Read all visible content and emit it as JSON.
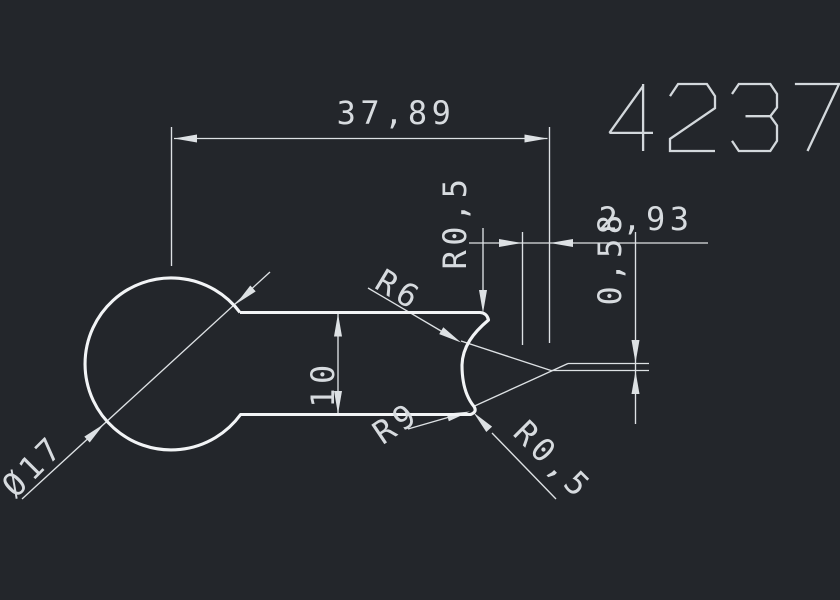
{
  "drawing_number": "4237",
  "canvas": {
    "width": 840,
    "height": 600,
    "background": "#23262b"
  },
  "colors": {
    "background": "#23262b",
    "outline": "#f2f4f6",
    "dimension": "#dde1e4",
    "text": "#d7dbdf",
    "digits": "#d3d8dc"
  },
  "part": {
    "description": "keyhole profile: circle with flat tongue ending in concave notch",
    "outline_path": "M 240 312.5 L 480 312.5 Q 487 313 488.5 320 C 473 333 462.5 347 462 365 C 462 386 467 398 474 406.5 Q 477.5 412 470.5 414.5 L 240.6 414.5 A 86 86 0 1 1 240 312.5",
    "outline_width": 3.1
  },
  "dimensions": {
    "line_width": 1.35,
    "arrow_length": 23,
    "arrow_half_width": 4,
    "font_size": 32,
    "letter_spacing": 4.5,
    "lines": [
      {
        "name": "ext-line-left-37-89",
        "p": [
          171.5,
          127,
          171.5,
          266
        ]
      },
      {
        "name": "ext-line-right-37-89",
        "p": [
          549.5,
          127,
          549.5,
          343
        ]
      },
      {
        "name": "dim-line-37-89",
        "p": [
          174,
          138.5,
          547.5,
          138.5
        ]
      },
      {
        "name": "ext-line-left-2-93",
        "p": [
          522.5,
          232,
          522.5,
          345
        ]
      },
      {
        "name": "dim-line-2-93",
        "p": [
          469,
          243,
          708,
          243
        ]
      },
      {
        "name": "dim-line-0-58",
        "p": [
          635.5,
          232,
          635.5,
          424
        ]
      },
      {
        "name": "ext-line-upper-0-58",
        "p": [
          568,
          363.5,
          649,
          363.5
        ]
      },
      {
        "name": "ext-line-lower-0-58",
        "p": [
          551,
          370.5,
          649,
          370.5
        ]
      },
      {
        "name": "ext-diagonal-upper",
        "p": [
          461,
          341,
          551,
          370.5
        ]
      },
      {
        "name": "ext-diagonal-lower",
        "p": [
          473.5,
          406.5,
          568,
          363.5
        ]
      },
      {
        "name": "leader-r05-top",
        "p": [
          483,
          228,
          483,
          296
        ]
      },
      {
        "name": "dim-line-10",
        "p": [
          338,
          313,
          338,
          414.5
        ]
      },
      {
        "name": "leader-r6",
        "p": [
          368,
          288,
          447,
          334.5
        ]
      },
      {
        "name": "leader-r9",
        "p": [
          408,
          429,
          453,
          416
        ]
      },
      {
        "name": "leader-r05-bottom",
        "p": [
          492,
          433,
          556,
          499
        ]
      },
      {
        "name": "dim-line-dia17",
        "p": [
          22,
          499,
          270,
          272
        ]
      }
    ],
    "arrows": [
      {
        "name": "arrow-37-89-left",
        "tip": [
          174,
          138.5
        ],
        "angle": 180
      },
      {
        "name": "arrow-37-89-right",
        "tip": [
          547.5,
          138.5
        ],
        "angle": 0
      },
      {
        "name": "arrow-2-93-left",
        "tip": [
          522,
          243
        ],
        "angle": 0
      },
      {
        "name": "arrow-2-93-right",
        "tip": [
          550,
          243
        ],
        "angle": 180
      },
      {
        "name": "arrow-0-58-top",
        "tip": [
          635.5,
          363
        ],
        "angle": 90
      },
      {
        "name": "arrow-0-58-bottom",
        "tip": [
          635.5,
          371
        ],
        "angle": 270
      },
      {
        "name": "arrow-r05-top",
        "tip": [
          483,
          313
        ],
        "angle": 90
      },
      {
        "name": "arrow-10-top",
        "tip": [
          338,
          313.5
        ],
        "angle": 270
      },
      {
        "name": "arrow-10-bottom",
        "tip": [
          338,
          414
        ],
        "angle": 90
      },
      {
        "name": "arrow-r6",
        "tip": [
          461,
          342.5
        ],
        "angle": 31
      },
      {
        "name": "arrow-r9",
        "tip": [
          470,
          411.5
        ],
        "angle": -15
      },
      {
        "name": "arrow-r05-bottom",
        "tip": [
          473.5,
          412.5
        ],
        "angle": 227
      },
      {
        "name": "arrow-dia17-lower",
        "tip": [
          104,
          424
        ],
        "angle": -42.5
      },
      {
        "name": "arrow-dia17-upper",
        "tip": [
          236,
          304
        ],
        "angle": 137.5
      }
    ],
    "texts": [
      {
        "name": "dim-text-37-89",
        "value": "37,89",
        "x": 396,
        "y": 113,
        "rot": 0
      },
      {
        "name": "dim-text-2-93",
        "value": "2,93",
        "x": 646,
        "y": 219,
        "rot": 0
      },
      {
        "name": "dim-text-0-58",
        "value": "0,58",
        "x": 610,
        "y": 258,
        "rot": -90
      },
      {
        "name": "dim-text-r05-top",
        "value": "R0,5",
        "x": 455,
        "y": 222,
        "rot": -90
      },
      {
        "name": "dim-text-r6",
        "value": "R6",
        "x": 399,
        "y": 290,
        "rot": 31
      },
      {
        "name": "dim-text-r9",
        "value": "R9",
        "x": 396,
        "y": 423,
        "rot": -34
      },
      {
        "name": "dim-text-r05-bottom",
        "value": "R0,5",
        "x": 553,
        "y": 460,
        "rot": 45
      },
      {
        "name": "dim-text-10",
        "value": "10",
        "x": 323,
        "y": 384,
        "rot": -90
      },
      {
        "name": "dim-text-dia17",
        "value": "Ø17",
        "x": 33,
        "y": 466,
        "rot": -45
      }
    ]
  },
  "title_block": {
    "digits_box": {
      "x": 608,
      "y": 84,
      "digit_width": 45,
      "digit_height": 67,
      "advance": 62,
      "stroke_width": 2.3
    }
  }
}
